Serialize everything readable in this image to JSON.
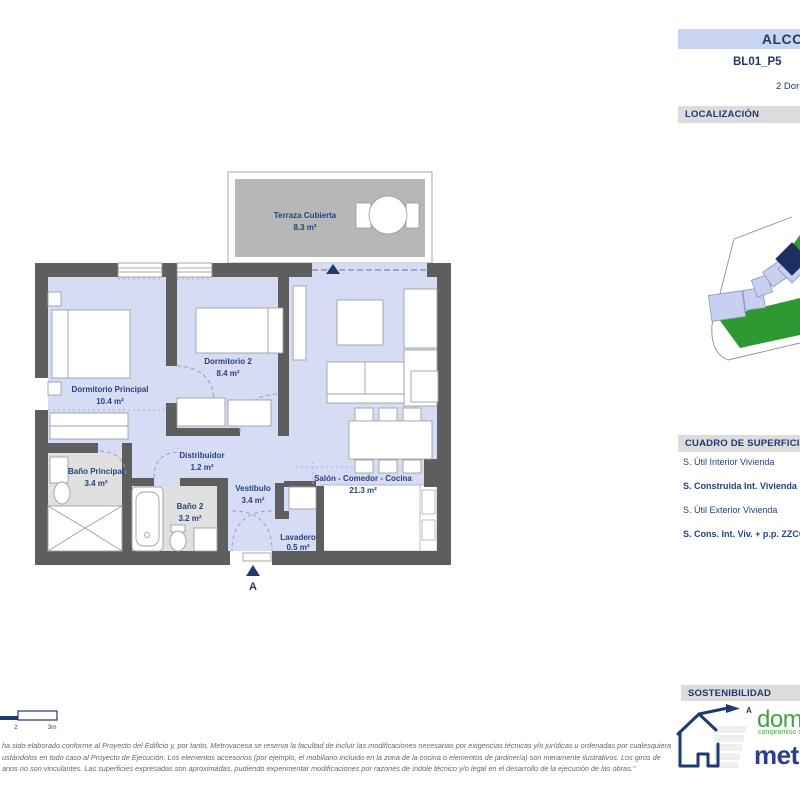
{
  "header": {
    "project_title": "ALCOR",
    "unit_code": "BL01_P5",
    "unit_type": "2 Dormitorios",
    "localization_title": "LOCALIZACIÓN"
  },
  "plan": {
    "rooms": [
      {
        "name": "Terraza Cubierta",
        "area": "8.3 m²"
      },
      {
        "name": "Dormitorio Principal",
        "area": "10.4 m²"
      },
      {
        "name": "Dormitorio 2",
        "area": "8.4 m²"
      },
      {
        "name": "Distribuidor",
        "area": "1.2 m²"
      },
      {
        "name": "Baño Principal",
        "area": "3.4 m²"
      },
      {
        "name": "Baño 2",
        "area": "3.2 m²"
      },
      {
        "name": "Vestíbulo",
        "area": "3.4 m²"
      },
      {
        "name": "Lavadero",
        "area": "0.5 m²"
      },
      {
        "name": "Salón - Comedor - Cocina",
        "area": "21.3 m²"
      }
    ],
    "entrance_marker": "A"
  },
  "surfaces": {
    "title": "CUADRO DE SUPERFICIES",
    "rows": [
      {
        "label": "S. Útil Interior Vivienda"
      },
      {
        "label": "S. Construida Int. Vivienda"
      },
      {
        "label": "S. Útil Exterior Vivienda"
      },
      {
        "label": "S. Cons. Int. Viv. + p.p. ZZCC"
      }
    ]
  },
  "sustainability": {
    "title": "SOSTENIBILIDAD",
    "energy_rating": "A"
  },
  "branding": {
    "domum": "domum",
    "domum_tagline": "compromiso sostenible",
    "metrovacesa": "metrovacesa"
  },
  "scale_bar": {
    "mid_label": "2",
    "end_label": "3m"
  },
  "disclaimer": {
    "line1": "ha sido elaborado conforme al Proyecto del Edificio y, por tanto, Metrovacesa se reserva la facultad de incluir las modificaciones necesarias por exigencias técnicas y/o jurídicas u ordenadas por cualesquiera",
    "line2": "ustándolos en todo caso al Proyecto de Ejecución. Los elementos accesorios (por ejemplo, el mobiliario incluido en la zona de la cocina o elementos de jardinería) son meramente ilustrativos. Los giros de",
    "line3": "arios no son vinculantes. Las superficies expresadas son aproximadas, pudiendo experimentar modificaciones por razones de índole técnico y/o legal en el desarrollo de la ejecución de las obras.\""
  },
  "colors": {
    "accent_navy": "#1E3A6E",
    "title_bar_bg": "#C9D6F3",
    "section_bar_bg": "#DCDCDC",
    "wall_gray": "#5E5E5E",
    "room_fill": "#D7DCF5",
    "wet_room_floor": "#E0E0E0",
    "terrace_floor": "#B7B7B7",
    "map_green": "#2E9932",
    "building_fill": "#C7D1EF",
    "highlight_navy": "#1C2F63",
    "domum_green": "#3FA43F",
    "metrovacesa_blue": "#2B3F92"
  }
}
